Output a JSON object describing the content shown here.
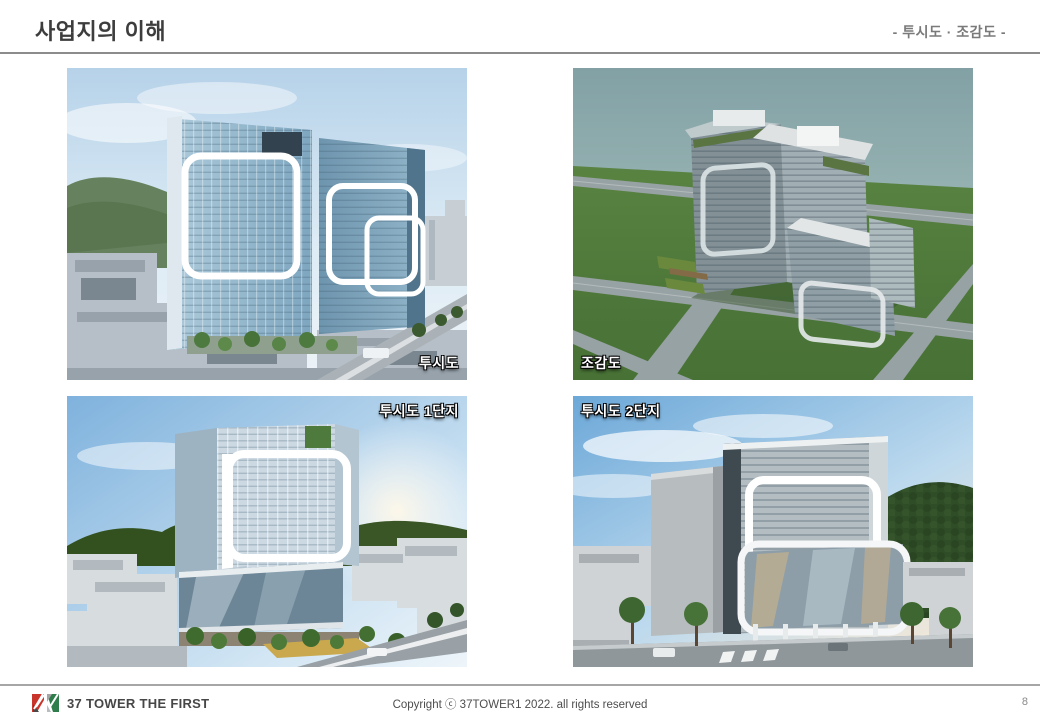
{
  "header": {
    "title": "사업지의 이해",
    "subtitle": "- 투시도 · 조감도 -"
  },
  "panels": [
    {
      "id": "perspective",
      "label": "투시도",
      "label_position": "bottom-right",
      "description": "perspective rendering of twin glass office towers"
    },
    {
      "id": "birdseye",
      "label": "조감도",
      "label_position": "bottom-left",
      "description": "aerial bird's-eye rendering of the building complex"
    },
    {
      "id": "complex1",
      "label": "투시도 1단지",
      "label_position": "top-right",
      "description": "perspective rendering of complex 1"
    },
    {
      "id": "complex2",
      "label": "투시도 2단지",
      "label_position": "top-left",
      "description": "perspective rendering of complex 2"
    }
  ],
  "footer": {
    "brand": "37 TOWER THE FIRST",
    "copyright": "Copyright ⓒ 37TOWER1 2022. all rights reserved",
    "page_number": "8"
  },
  "colors": {
    "title_text": "#3d3d3d",
    "subtitle_text": "#7a7a7a",
    "divider": "#8c8c8c",
    "label_text": "#ffffff",
    "logo_red": "#c9352b",
    "logo_dark": "#4a4a4a",
    "logo_green": "#2e7d4a",
    "logo_gray": "#a5a5a5"
  }
}
